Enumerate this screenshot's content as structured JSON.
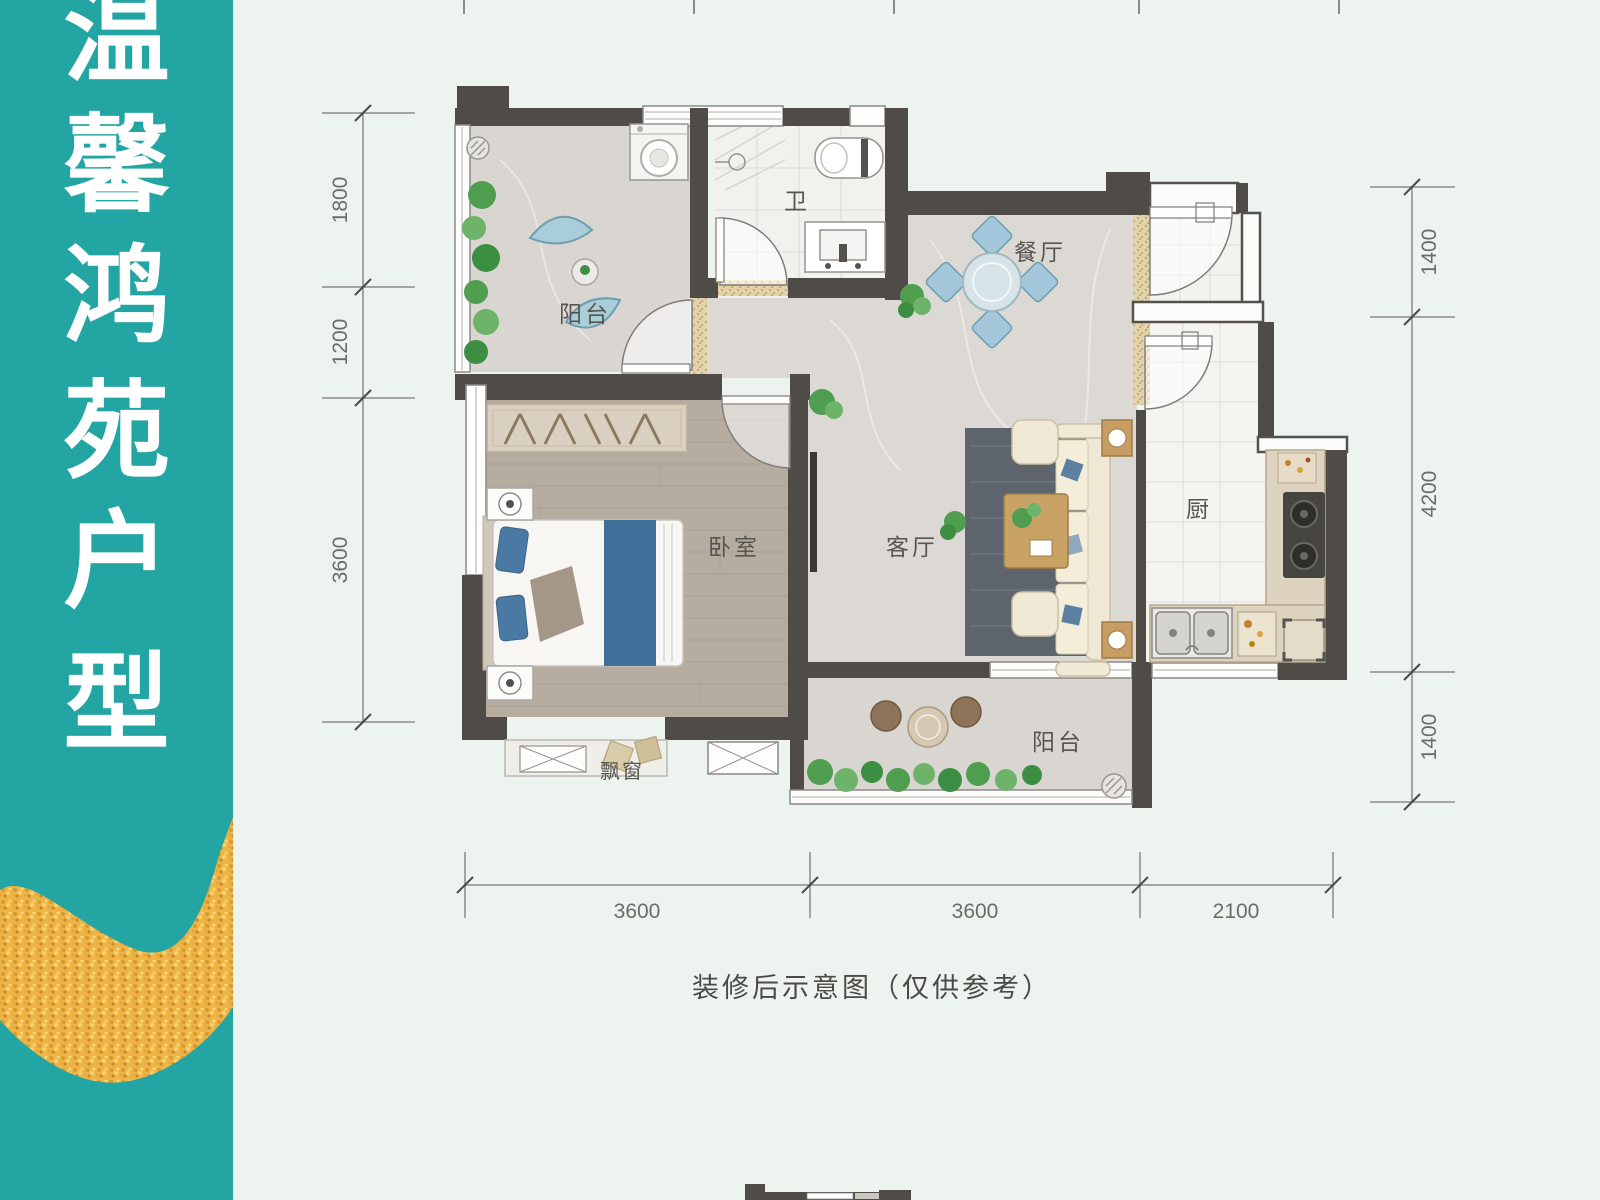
{
  "banner": {
    "characters": [
      "温",
      "馨",
      "鸿",
      "苑",
      "户",
      "型"
    ]
  },
  "rooms": {
    "balcony_top": "阳台",
    "bathroom": "卫",
    "dining": "餐厅",
    "bedroom": "卧室",
    "living": "客厅",
    "kitchen": "厨",
    "balcony_bottom": "阳台",
    "bay_window": "飘窗"
  },
  "dimensions": {
    "left": [
      "1800",
      "1200",
      "3600"
    ],
    "right": [
      "1400",
      "4200",
      "1400"
    ],
    "bottom": [
      "3600",
      "3600",
      "2100"
    ]
  },
  "caption": "装修后示意图（仅供参考）",
  "colors": {
    "banner_teal": "#23a5a3",
    "gold_stroke": "#efb446",
    "wall": "#4f4b47",
    "marble_floor": "#dcd9d5",
    "wood_floor": "#b6aca0",
    "tile_floor": "#f3f3f0",
    "accent_blue": "#4a7aa4",
    "page_background": "#edf3ee"
  }
}
